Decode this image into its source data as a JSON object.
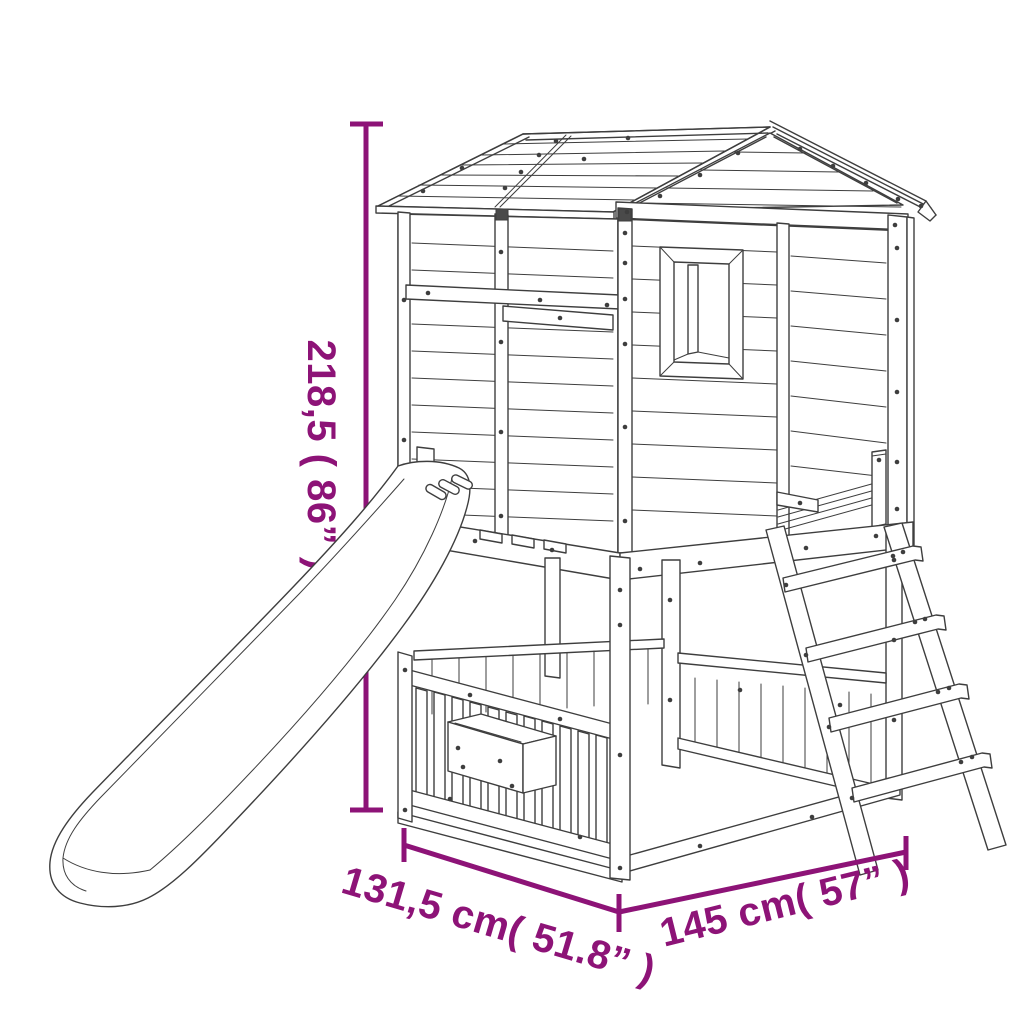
{
  "figure": {
    "type": "product-dimension-diagram",
    "subject": "wooden playhouse with slide and ladder",
    "style": "black line drawing on white background with purple dimension lines"
  },
  "colors": {
    "accent": "#8d1377",
    "line_art": "#3e3e3e",
    "background": "#ffffff"
  },
  "dimensions": {
    "height": {
      "label": "218,5 ( 86” )",
      "value_cm": "218,5",
      "value_in": "86",
      "orientation": "vertical-left"
    },
    "depth": {
      "label": "131,5 cm( 51.8” )",
      "value_cm": "131,5",
      "value_in": "51.8",
      "orientation": "diagonal-bottom-left"
    },
    "width": {
      "label": "145 cm( 57” )",
      "value_cm": "145",
      "value_in": "57",
      "orientation": "diagonal-bottom-right"
    }
  }
}
